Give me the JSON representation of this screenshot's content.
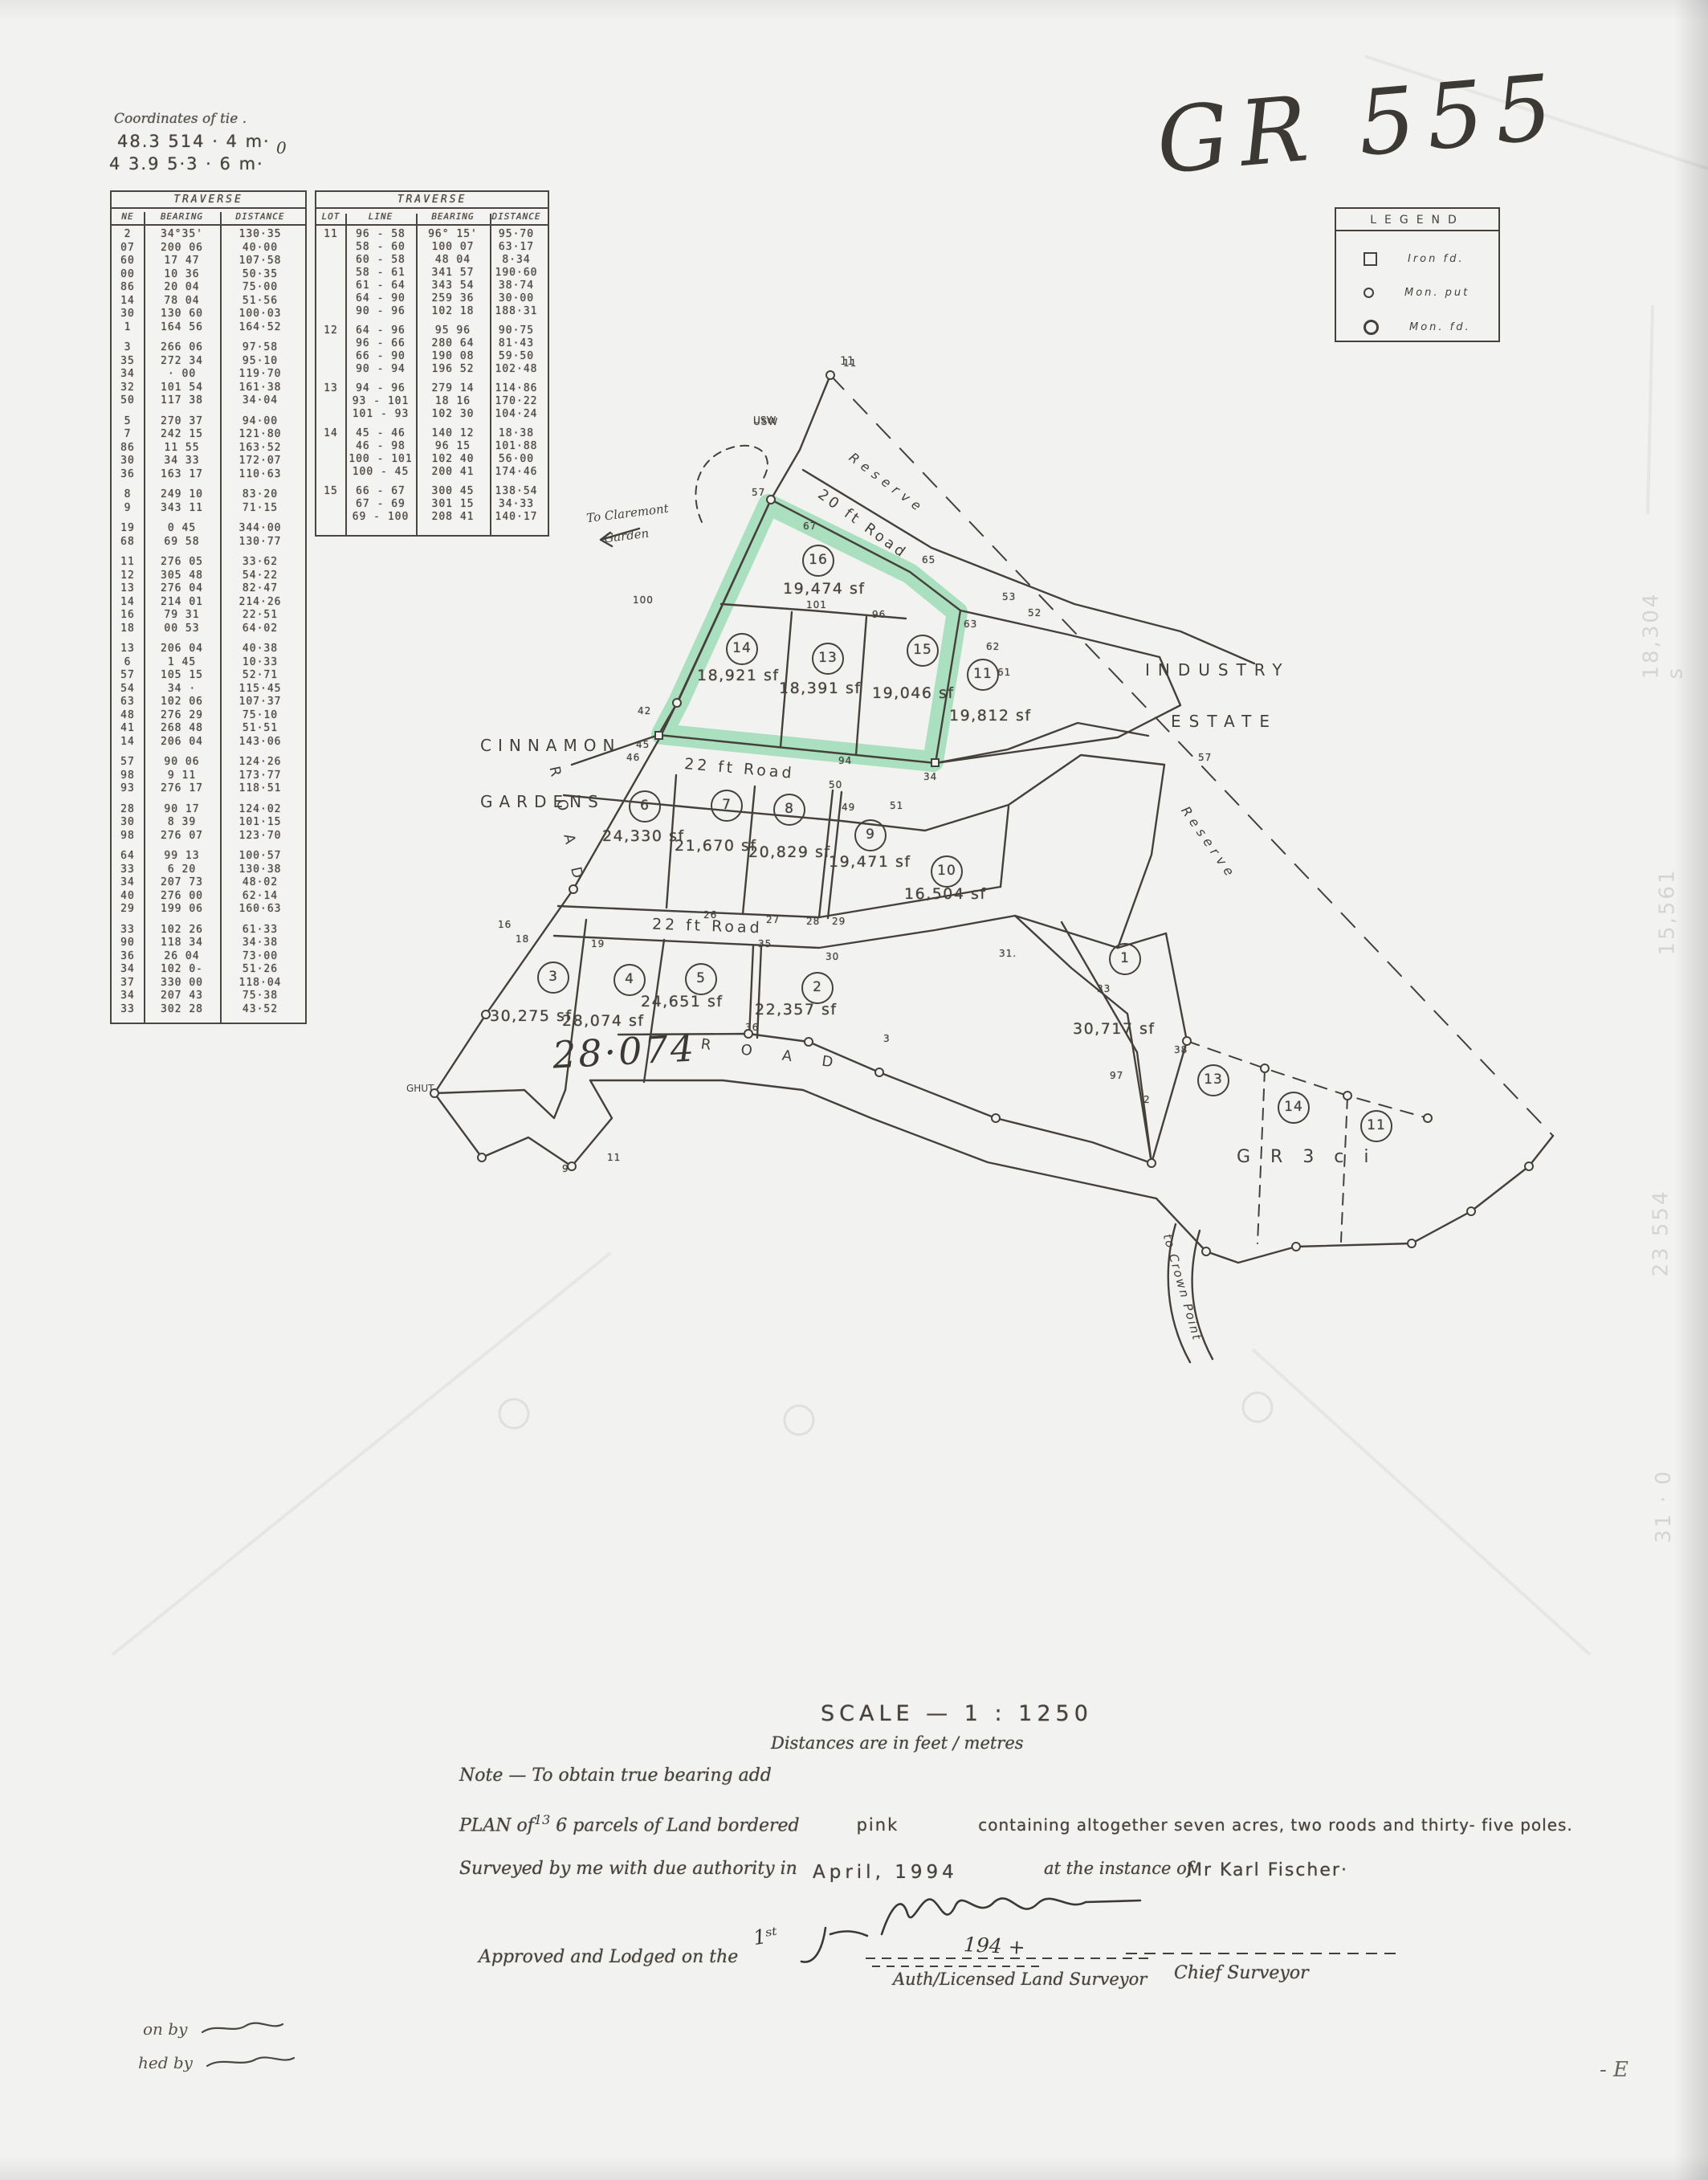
{
  "page": {
    "corner_notes": [
      "Coordinates of tie .",
      "48.3   514 · 4 m·",
      "4 3.9   5·3 · 6 m·"
    ],
    "corner_zero": "0",
    "handwriting_top_right": "GR 555",
    "bottom_left_line1": "on by",
    "bottom_left_line2": "hed by",
    "bottom_right_mark": "- E"
  },
  "tables": {
    "left": {
      "title": "TRAVERSE",
      "headers": [
        "NE",
        "BEARING",
        "DISTANCE"
      ],
      "groups": [
        [
          [
            "2",
            "34°35'",
            "130·35"
          ],
          [
            "07",
            "200 06",
            "40·00"
          ],
          [
            "60",
            "17 47",
            "107·58"
          ],
          [
            "00",
            "10 36",
            "50·35"
          ],
          [
            "86",
            "20 04",
            "75·00"
          ],
          [
            "14",
            "78 04",
            "51·56"
          ],
          [
            "30",
            "130 60",
            "100·03"
          ],
          [
            "1",
            "164 56",
            "164·52"
          ]
        ],
        [
          [
            "3",
            "266 06",
            "97·58"
          ],
          [
            "35",
            "272 34",
            "95·10"
          ],
          [
            "34",
            "· 00",
            "119·70"
          ],
          [
            "32",
            "101 54",
            "161·38"
          ],
          [
            "50",
            "117 38",
            "34·04"
          ]
        ],
        [
          [
            "5",
            "270 37",
            "94·00"
          ],
          [
            "7",
            "242 15",
            "121·80"
          ],
          [
            "86",
            "11 55",
            "163·52"
          ],
          [
            "30",
            "34 33",
            "172·07"
          ],
          [
            "36",
            "163 17",
            "110·63"
          ]
        ],
        [
          [
            "8",
            "249 10",
            "83·20"
          ],
          [
            "9",
            "343 11",
            "71·15"
          ]
        ],
        [
          [
            "19",
            "0 45",
            "344·00"
          ],
          [
            "68",
            "69 58",
            "130·77"
          ]
        ],
        [
          [
            "11",
            "276 05",
            "33·62"
          ],
          [
            "12",
            "305 48",
            "54·22"
          ],
          [
            "13",
            "276 04",
            "82·47"
          ],
          [
            "14",
            "214 01",
            "214·26"
          ],
          [
            "16",
            "79 31",
            "22·51"
          ],
          [
            "18",
            "00 53",
            "64·02"
          ]
        ],
        [
          [
            "13",
            "206 04",
            "40·38"
          ],
          [
            "6",
            "1 45",
            "10·33"
          ],
          [
            "57",
            "105 15",
            "52·71"
          ],
          [
            "54",
            "34 ·",
            "115·45"
          ],
          [
            "63",
            "102 06",
            "107·37"
          ],
          [
            "48",
            "276 29",
            "75·10"
          ],
          [
            "41",
            "268 48",
            "51·51"
          ],
          [
            "14",
            "206 04",
            "143·06"
          ]
        ],
        [
          [
            "57",
            "90 06",
            "124·26"
          ],
          [
            "98",
            "9 11",
            "173·77"
          ],
          [
            "93",
            "276 17",
            "118·51"
          ]
        ],
        [
          [
            "28",
            "90 17",
            "124·02"
          ],
          [
            "30",
            "8 39",
            "101·15"
          ],
          [
            "98",
            "276 07",
            "123·70"
          ]
        ],
        [
          [
            "64",
            "99 13",
            "100·57"
          ],
          [
            "33",
            "6 20",
            "130·38"
          ],
          [
            "34",
            "207 73",
            "48·02"
          ],
          [
            "40",
            "276 00",
            "62·14"
          ],
          [
            "29",
            "199 06",
            "160·63"
          ]
        ],
        [
          [
            "33",
            "102 26",
            "61·33"
          ],
          [
            "90",
            "118 34",
            "34·38"
          ],
          [
            "36",
            "26 04",
            "73·00"
          ],
          [
            "34",
            "102 0-",
            "51·26"
          ],
          [
            "37",
            "330 00",
            "118·04"
          ],
          [
            "34",
            "207 43",
            "75·38"
          ],
          [
            "33",
            "302 28",
            "43·52"
          ]
        ]
      ]
    },
    "lots": {
      "title": "TRAVERSE",
      "headers": [
        "LOT",
        "LINE",
        "BEARING",
        "DISTANCE"
      ],
      "groups": [
        {
          "lot": "11",
          "rows": [
            [
              "96 - 58",
              "96° 15'",
              "95·70"
            ],
            [
              "58 - 60",
              "100 07",
              "63·17"
            ],
            [
              "60 - 58",
              "48 04",
              "8·34"
            ],
            [
              "58 - 61",
              "341 57",
              "190·60"
            ],
            [
              "61 - 64",
              "343 54",
              "38·74"
            ],
            [
              "64 - 90",
              "259 36",
              "30·00"
            ],
            [
              "90 - 96",
              "102 18",
              "188·31"
            ]
          ]
        },
        {
          "lot": "12",
          "rows": [
            [
              "64 - 96",
              "95 96",
              "90·75"
            ],
            [
              "96 - 66",
              "280 64",
              "81·43"
            ],
            [
              "66 - 90",
              "190 08",
              "59·50"
            ],
            [
              "90 - 94",
              "196 52",
              "102·48"
            ]
          ]
        },
        {
          "lot": "13",
          "rows": [
            [
              "94 - 96",
              "279 14",
              "114·86"
            ],
            [
              "93 - 101",
              "18 16",
              "170·22"
            ],
            [
              "101 - 93",
              "102 30",
              "104·24"
            ]
          ]
        },
        {
          "lot": "14",
          "rows": [
            [
              "45 - 46",
              "140 12",
              "18·38"
            ],
            [
              "46 - 98",
              "96 15",
              "101·88"
            ],
            [
              "100 - 101",
              "102 40",
              "56·00"
            ],
            [
              "100 - 45",
              "200 41",
              "174·46"
            ]
          ]
        },
        {
          "lot": "15",
          "rows": [
            [
              "66 - 67",
              "300 45",
              "138·54"
            ],
            [
              "67 - 69",
              "301 15",
              "34·33"
            ],
            [
              "69 - 100",
              "208 41",
              "140·17"
            ]
          ]
        }
      ]
    }
  },
  "legend": {
    "title": "LEGEND",
    "items": [
      {
        "symbol": "square",
        "label": "Iron  fd."
      },
      {
        "symbol": "dot",
        "label": "Mon. put"
      },
      {
        "symbol": "circle",
        "label": "Mon. fd."
      }
    ]
  },
  "map": {
    "lots": [
      {
        "num": "16",
        "area": "19,474 sf"
      },
      {
        "num": "14",
        "area": "18,921 sf"
      },
      {
        "num": "13",
        "area": "18,391 sf"
      },
      {
        "num": "15",
        "area": "19,046 sf"
      },
      {
        "num": "11",
        "area": "19,812 sf"
      },
      {
        "num": "6",
        "area": "24,330 sf"
      },
      {
        "num": "7",
        "area": "21,670 sf"
      },
      {
        "num": "8",
        "area": "20,829 sf"
      },
      {
        "num": "9",
        "area": "19,471 sf"
      },
      {
        "num": "10",
        "area": "16,504 sf"
      },
      {
        "num": "3",
        "area": "30,275 sf"
      },
      {
        "num": "4",
        "area": "28,074 sf"
      },
      {
        "num": "5",
        "area": "24,651 sf"
      },
      {
        "num": "2",
        "area": "22,357 sf"
      },
      {
        "num": "1",
        "area": "30,717 sf"
      },
      {
        "num": "13",
        "area": ""
      },
      {
        "num": "14",
        "area": ""
      },
      {
        "num": "11",
        "area": ""
      }
    ],
    "roads": [
      "20 ft Road",
      "22 ft Road",
      "22 ft Road",
      "R O A D",
      "R O A D"
    ],
    "labels": {
      "reserve1": "Reserve",
      "reserve2": "Reserve",
      "cinnamon": "CINNAMON",
      "gardens": "GARDENS",
      "industry": "INDUSTRY",
      "estate": "ESTATE",
      "to_claremont1": "To Claremont",
      "to_claremont2": "Garden",
      "to_crown_point": "to Crown Point",
      "gr3": "G R  3 c i",
      "ghut": "GHUT",
      "usw": "USW",
      "apex": "11",
      "handwritten_area": "28·074"
    },
    "vertex_labels": [
      "11",
      "USW",
      "57",
      "67",
      "65",
      "53",
      "52",
      "100",
      "101",
      "96",
      "63",
      "62",
      "61",
      "42",
      "45",
      "94",
      "34",
      "46",
      "50",
      "49",
      "51",
      "57",
      "26",
      "27",
      "28",
      "29",
      "31.",
      "33",
      "16",
      "18",
      "19",
      "35",
      "30",
      "36",
      "3",
      "97",
      "2",
      "38",
      "9",
      "11"
    ],
    "ghosts": [
      "18,304 s",
      "15,561",
      "23 554",
      "31 · 0"
    ]
  },
  "footer": {
    "scale": "SCALE — 1 : 1250",
    "scale_sub": "Distances are in feet / metres",
    "note": "Note — To obtain true bearing add",
    "plan_p1": "PLAN of",
    "plan_sup": "13",
    "plan_p2": "6 parcels of Land bordered",
    "plan_pink": "pink",
    "plan_p4": "containing  altogether  seven  acres,  two  roods  and  thirty- five  poles.",
    "surveyed": "Surveyed by me with due authority in",
    "date": "April,  1994",
    "instance": "at the instance of",
    "client": "Mr  Karl  Fischer·",
    "surveyor_title": "Auth/Licensed Land Surveyor",
    "approved": "Approved and Lodged on the",
    "approved_day": "1ˢᵗ",
    "approved_year": "194 +",
    "chief": "Chief Surveyor"
  }
}
